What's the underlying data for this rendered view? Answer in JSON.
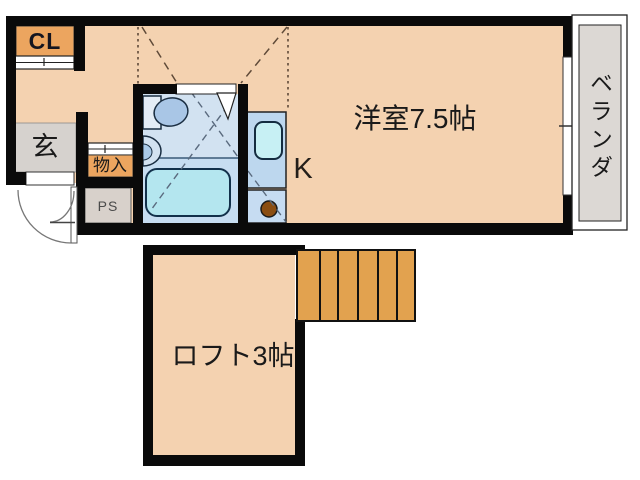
{
  "plan": {
    "rooms": {
      "closet": {
        "label": "CL"
      },
      "entrance": {
        "label": "玄"
      },
      "storage": {
        "label": "物入"
      },
      "pipe_space": {
        "label": "PS"
      },
      "kitchen": {
        "label": "K"
      },
      "western_room": {
        "label": "洋室7.5帖"
      },
      "balcony": {
        "label": "ベランダ"
      },
      "loft": {
        "label": "ロフト3帖"
      }
    },
    "colors": {
      "wall": "#0a0a0a",
      "floor": "#f4d2b0",
      "accent_orange": "#eca55f",
      "stairs_orange": "#e2a24f",
      "bath_floor": "#d2e2f1",
      "bath_floor_lower": "#c7ddf1",
      "fixture_cyan": "#b4e6ef",
      "fixture_blue": "#a9c6e6",
      "kitchen_panel": "#bdd7ee",
      "kitchen_panel_lower": "#c6dcf2",
      "kitchen_sink": "#c7f0f4",
      "burner_brown": "#8a4d12",
      "entrance_gray": "#d6d2ce",
      "ps_gray": "#d8d1cb",
      "balcony_gray": "#dcd8d4",
      "dash_gray": "#5a6a7e",
      "dash_brown": "#5f4a38",
      "text": "#1a1a1a"
    }
  }
}
